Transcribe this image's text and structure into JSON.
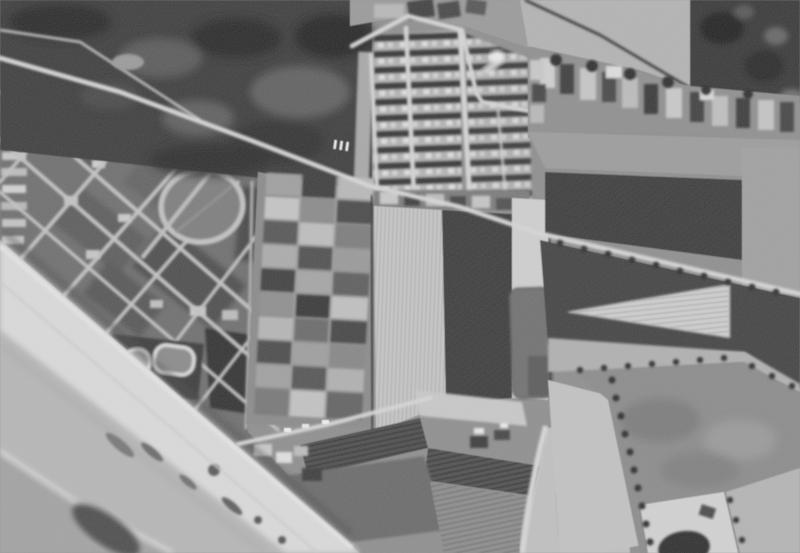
{
  "palette": {
    "base": "#8e8e8e",
    "woodland": "#3c3c3c",
    "trees_dark": "#383838",
    "water": "#a2a2a2",
    "sand_lower": "#b6b6b6",
    "sand_upper": "#dadada",
    "town": "#6e6e6e",
    "street": "#c2c2c2",
    "road": "#d6d6d6",
    "railway": "#cfcfcf",
    "dark_field": "#3a3a3a",
    "dark_field_south": "#424242",
    "light_field": "#c6c6c6",
    "pale_strip": "#cfcfcf",
    "mid_field": "#8b8b8b",
    "ribbon_band": "#8f8f8f",
    "upper_field": "#b3b3b3",
    "hedge": "#2f2f2f",
    "pool_white": "#dcdcdc",
    "dark_patch": "#6f6f6f",
    "wedge_field": "#cdcdcd",
    "plots_strip": "#c0c0c0",
    "bright_zone": "#d2d2d2",
    "pond_blob": "#2f2f2f",
    "glare": "#f0f0f0",
    "surf": "#e0e0e0",
    "promenade": "#e3e3e3"
  }
}
